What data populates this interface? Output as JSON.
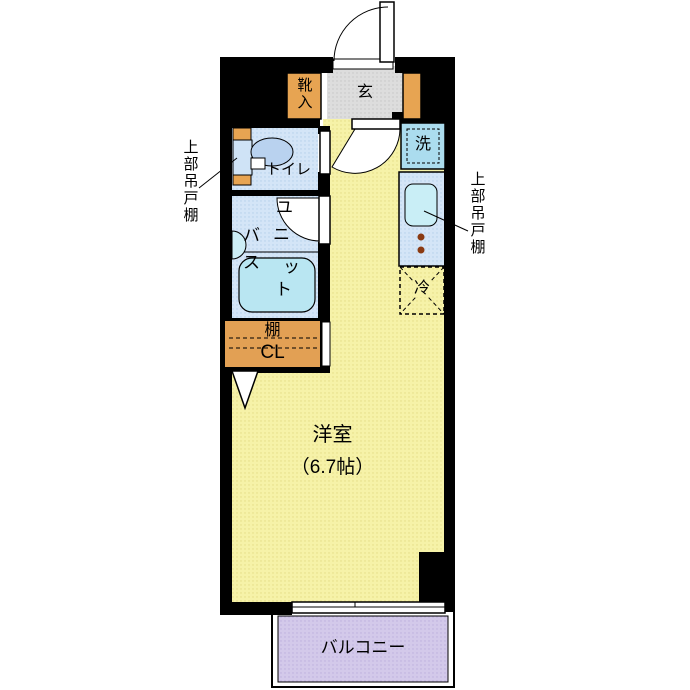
{
  "plan": {
    "entrance_label": "玄",
    "shoe_cabinet_label": "靴入",
    "toilet_label": "トイレ",
    "unit_bath_chars": [
      "ユ",
      "ニ",
      "ッ",
      "ト",
      "バ",
      "ス"
    ],
    "washer_label": "洗",
    "fridge_label": "冷",
    "shelf_label": "棚",
    "closet_label": "CL",
    "room_label": "洋室",
    "room_size": "（6.7帖）",
    "balcony_label": "バルコニー",
    "cabinet_note_left": "上部吊戸棚",
    "cabinet_note_right": "上部吊戸棚",
    "colors": {
      "wall": "#000000",
      "floor_yellow": "#f6f2a8",
      "entrance_gray": "#dcdcdc",
      "wet_area_blue": "#d3e4f6",
      "balcony_purple": "#d2c8ea",
      "cabinet_orange": "#e7a452",
      "fixture_cyan": "#bfe7f2",
      "burner_red": "#8a3a12"
    }
  }
}
